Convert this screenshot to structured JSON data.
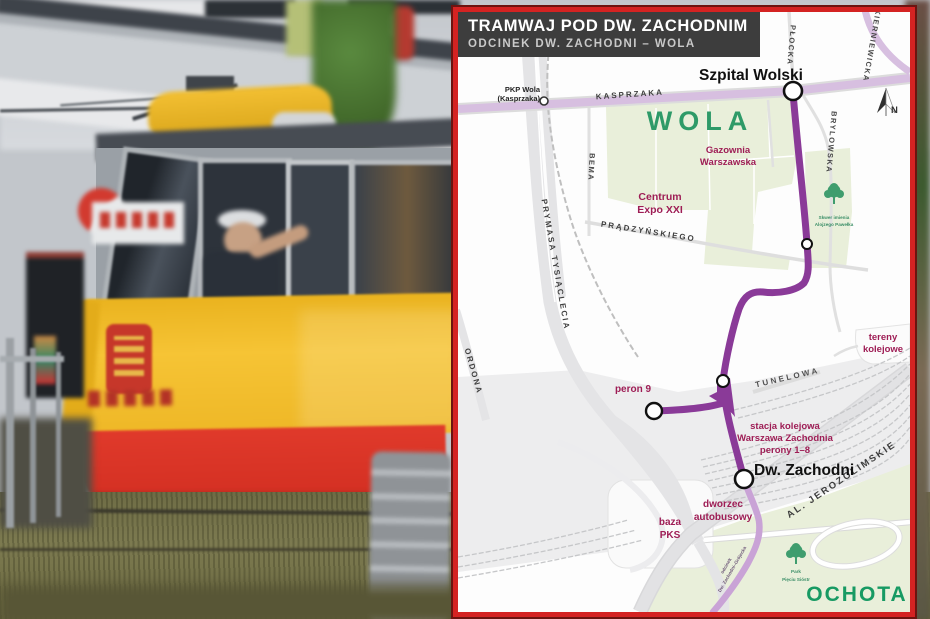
{
  "colors": {
    "frame_red": "#d42322",
    "header_bg": "#3d3d3d",
    "route_purple": "#8a3a98",
    "route_planned_light": "#c9a3d6",
    "tram_road_lilac": "#d7bfe0",
    "district_green_text": "#2e9a68",
    "poi_maroon_text": "#9e1d55",
    "park_fill": "#e9efda",
    "railway_gray": "#ededee",
    "tram_yellow": "#f0b827",
    "tram_red": "#e0392b"
  },
  "map": {
    "header": {
      "title": "TRAMWAJ POD DW. ZACHODNIM",
      "subtitle": "ODCINEK DW. ZACHODNI – WOLA"
    },
    "districts": {
      "wola": "WOLA",
      "ochota": "OCHOTA"
    },
    "stops": {
      "szpital_wolski": "Szpital Wolski",
      "dw_zachodni": "Dw. Zachodni",
      "peron_9": "peron 9"
    },
    "station": {
      "pkp_wola": [
        "PKP Wola",
        "(Kasprzaka)"
      ]
    },
    "streets": {
      "kasprzaka": "KASPRZAKA",
      "plocka": "PŁOCKA",
      "skierniewicka": "SKIERNIEWICKA",
      "brylowska": "BRYLOWSKA",
      "bema": "BEMA",
      "prymasa": "PRYMASA TYSIĄCLECIA",
      "ordona": "ORDONA",
      "pradzynskiego": "PRĄDZYŃSKIEGO",
      "tunelowa": "TUNELOWA",
      "jerozolimskie": "AL. JEROZOLIMSKIE"
    },
    "pois": {
      "gazownia": [
        "Gazownia",
        "Warszawska"
      ],
      "centrum_expo": [
        "Centrum",
        "Expo XXI"
      ],
      "skwer": [
        "Skwer imienia",
        "Alojzego Pawełka"
      ],
      "tereny": [
        "tereny",
        "kolejowe"
      ],
      "stacja": [
        "stacja kolejowa",
        "Warszawa Zachodnia",
        "perony 1–8"
      ],
      "dworzec": [
        "dworzec",
        "autobusowy"
      ],
      "baza": [
        "baza",
        "PKS"
      ],
      "park": [
        "Park",
        "Pięciu Sióstr"
      ],
      "odcinek": [
        "odcinek",
        "Dw. Zachodni–Grójecka"
      ]
    },
    "compass_n": "N"
  }
}
